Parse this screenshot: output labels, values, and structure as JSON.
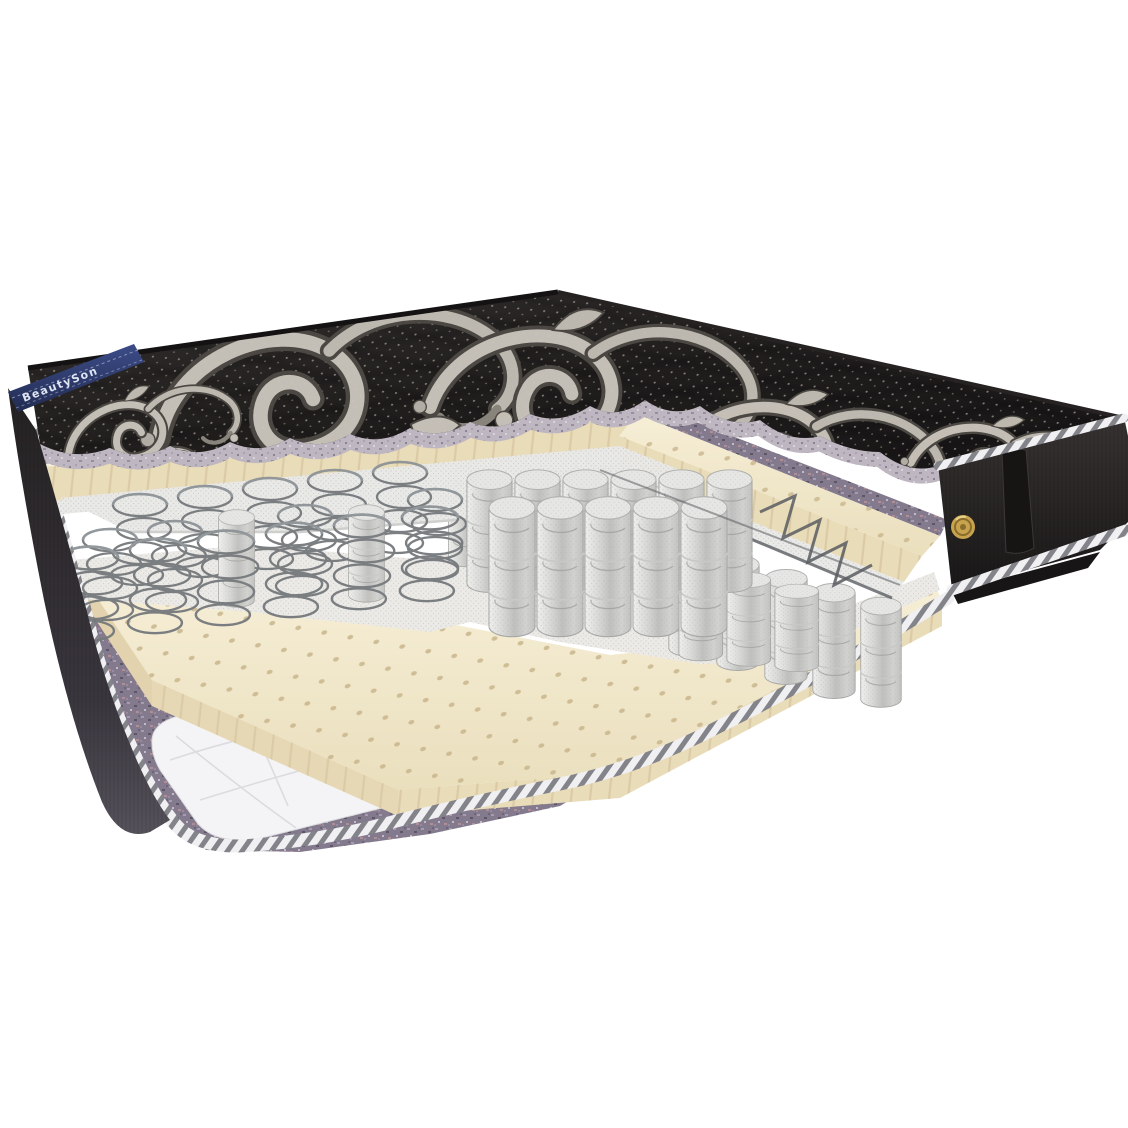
{
  "scene": {
    "subject": "mattress cutaway 3D render",
    "background": "#ffffff"
  },
  "brand_tape": {
    "text": "BeautySon",
    "bg": "#2c3a6e",
    "fg": "#dfe5f2"
  },
  "palette": {
    "cover_black": "#221f1f",
    "cover_dot": "#968f88",
    "damask_light": "#cbc6bd",
    "damask_dark": "#4e4a45",
    "felt_purple": "#837a8d",
    "felt_trim": "#beb6c0",
    "latex_cream": "#f3e9cd",
    "latex_edge": "#e9dcb9",
    "latex_hole": "#cbb88f",
    "spunbond_white": "#eceae6",
    "spring_fabric": "#d8d8d6",
    "spring_wire": "#75797c",
    "piping_gray": "#83838a",
    "piping_light": "#f0f0f2",
    "side_panel": "#262323",
    "handle_black": "#171414",
    "vent_gold": "#c7a34d",
    "vent_ring": "#8a6c2c",
    "bottom_quilt": "#f4f4f6"
  }
}
